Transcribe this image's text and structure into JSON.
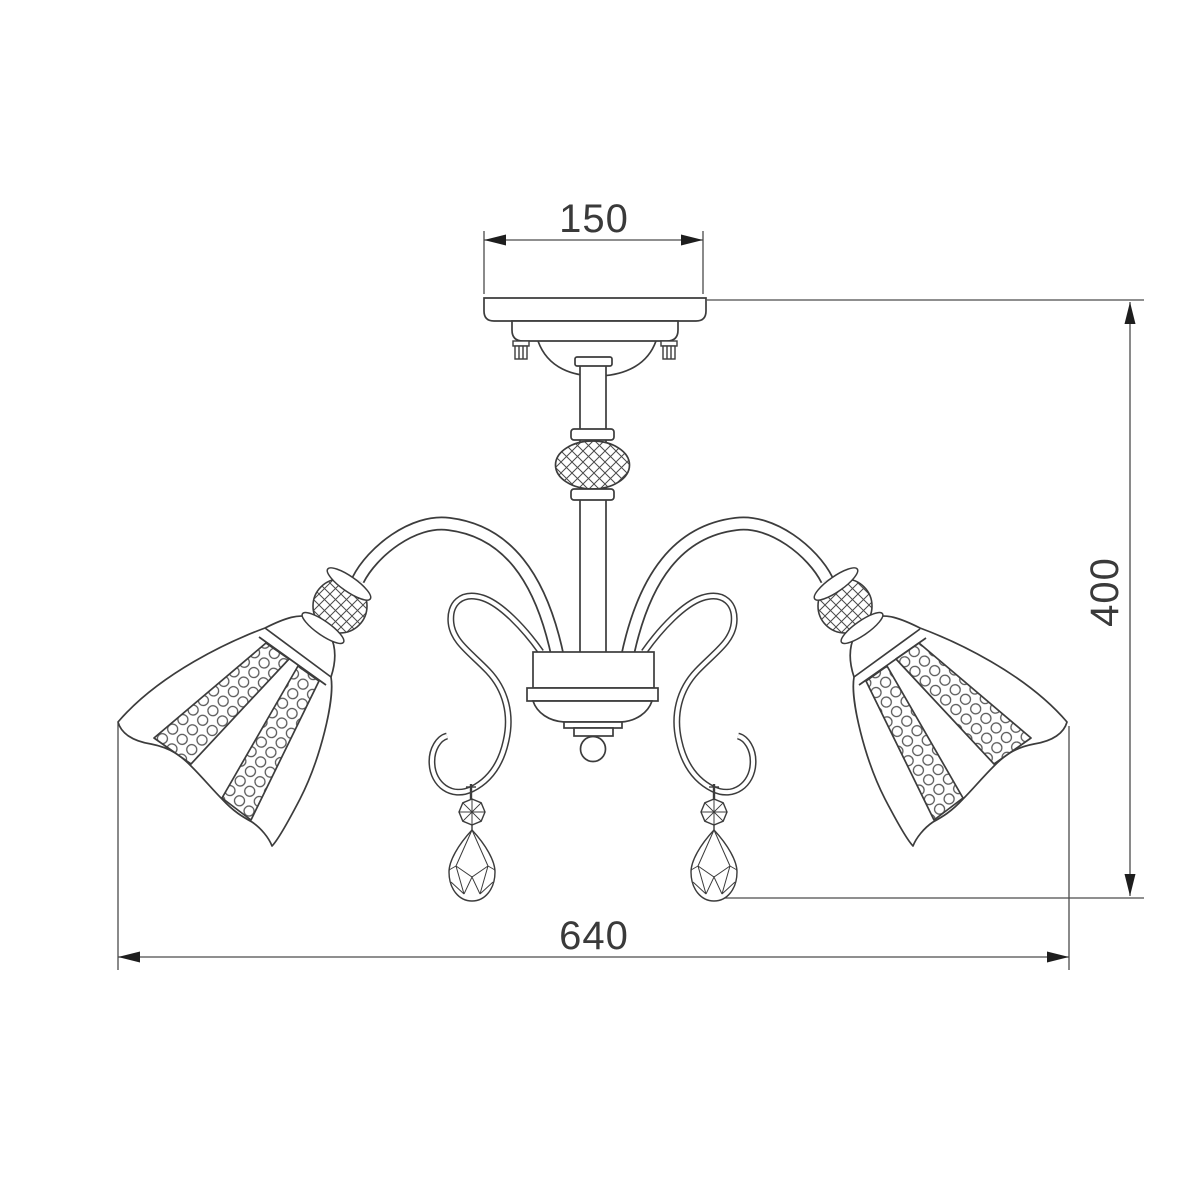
{
  "page": {
    "background": "#ffffff"
  },
  "drawing": {
    "kind": "technical dimension drawing",
    "subject": "ceiling chandelier with bell shades and crystal pendants",
    "line_color": "#3c3c3c",
    "dimension_line_color": "#4c4c4c",
    "arrow_color": "#1e1e1e",
    "dimensions": [
      {
        "id": "canopy-width",
        "label": "150",
        "orientation": "horizontal",
        "location": "top"
      },
      {
        "id": "overall-height",
        "label": "400",
        "orientation": "vertical",
        "location": "right"
      },
      {
        "id": "overall-width",
        "label": "640",
        "orientation": "horizontal",
        "location": "bottom"
      }
    ]
  }
}
